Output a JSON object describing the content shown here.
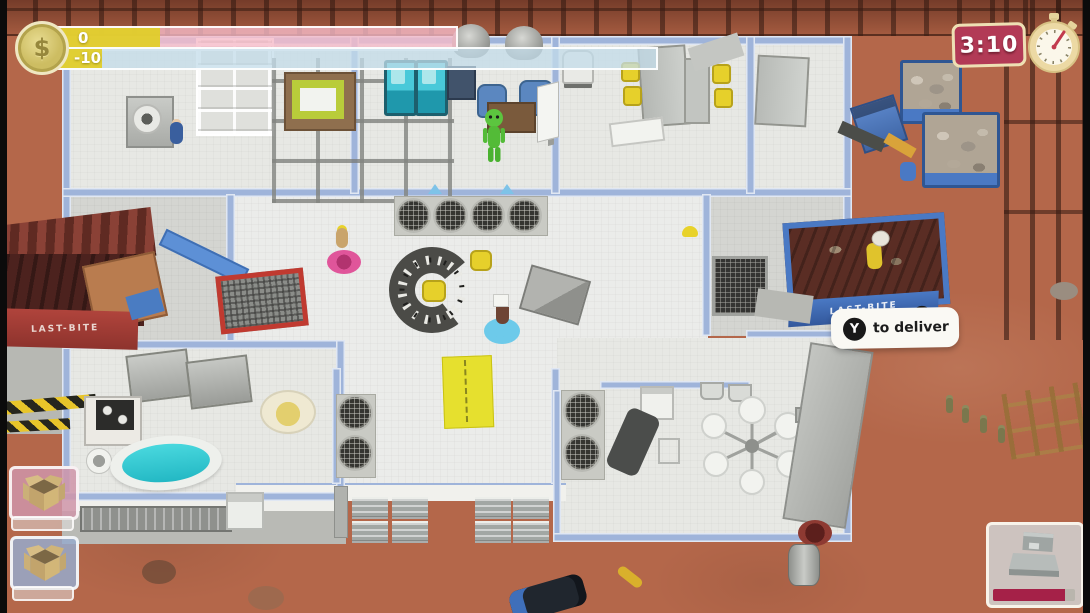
{
  "hud": {
    "money": {
      "symbol": "$",
      "earned": "0",
      "balance": "-10",
      "earned_fill_style": "width:118px",
      "balance_fill_style": "width:60px",
      "earned_track_color": "#f5bac8",
      "balance_track_color": "#c3dcea",
      "fill_color": "#e0cd2a"
    },
    "timer": {
      "value": "3:10",
      "bg_color": "#b23a56",
      "border_color": "#eee0b4"
    },
    "prompt": {
      "button": "Y",
      "label": "to deliver"
    },
    "inventory_cards": [
      {
        "icon": "cardboard-box",
        "bg_color": "#cf95a9"
      },
      {
        "icon": "cardboard-box",
        "bg_color": "#96aacb"
      }
    ],
    "build_card": {
      "icon": "countertop-machine",
      "progress_style": "width:88%",
      "progress_color": "#a52148"
    }
  },
  "scene": {
    "trucks": {
      "left_label": "LAST-BITE",
      "right_label": "LAST-BITE"
    },
    "characters": [
      "green-alien",
      "worker-blue",
      "worker-carrier",
      "worker-truck"
    ],
    "time_of_day": "day"
  }
}
